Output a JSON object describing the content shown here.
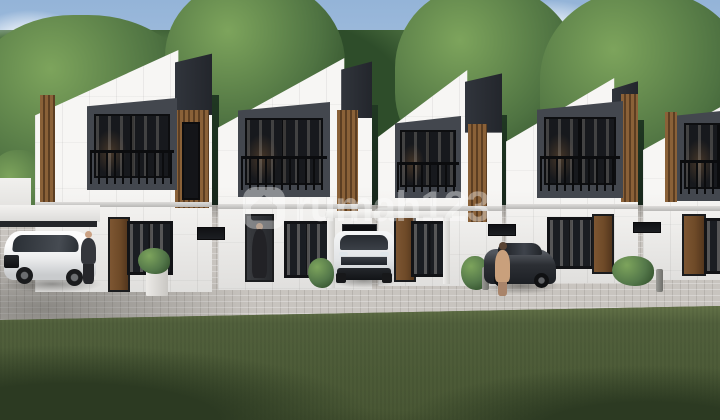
{
  "watermark": {
    "text": "rumah123",
    "icon": "rounded-house-badge",
    "opacity": "0.38"
  },
  "scene": {
    "type": "3d-architectural-exterior-render",
    "subject": "Row of five modern two-storey minimalist townhouses",
    "features": [
      "slanted parapet roofs with dark charcoal peak blocks",
      "white panelled facades with vertical wooden slat accents",
      "recessed dark-framed balconies with glass doors and railings",
      "ground-floor wooden doors and black-framed windows",
      "carports, grey paver driveway and front lawn",
      "trees and blue sky with clouds in the background"
    ],
    "vehicles": [
      "white MPV parked at far left carport",
      "white SUV parked facing forward in center carport",
      "dark grey sedan parked at right"
    ],
    "people": [
      "man in dark suit at the first house entrance",
      "person in long dark robe at the second house entrance",
      "woman in tan dress beside the dark sedan"
    ]
  },
  "colors": {
    "sky_top": "#94b4d8",
    "sky_mid": "#b9cfe7",
    "sky_low": "#d9e4f1",
    "cloud": "#f2f6fa",
    "tree_light": "#7da45c",
    "tree_mid": "#4f7342",
    "tree_dark": "#2e4d2a",
    "wall_white": "#f7f6f4",
    "wall_shade": "#e0dfdd",
    "roof_dark": "#23262c",
    "frame_grey": "#43474e",
    "glass_dark": "#17191d",
    "wood": "#8a6138",
    "wood_dark": "#5c3e22",
    "door_brown": "#6e4a28",
    "paver": "#c8c4bf",
    "grass": "#56653f",
    "grass_dark": "#2c3a22",
    "watermark": "rgba(255,255,255,0.38)"
  }
}
